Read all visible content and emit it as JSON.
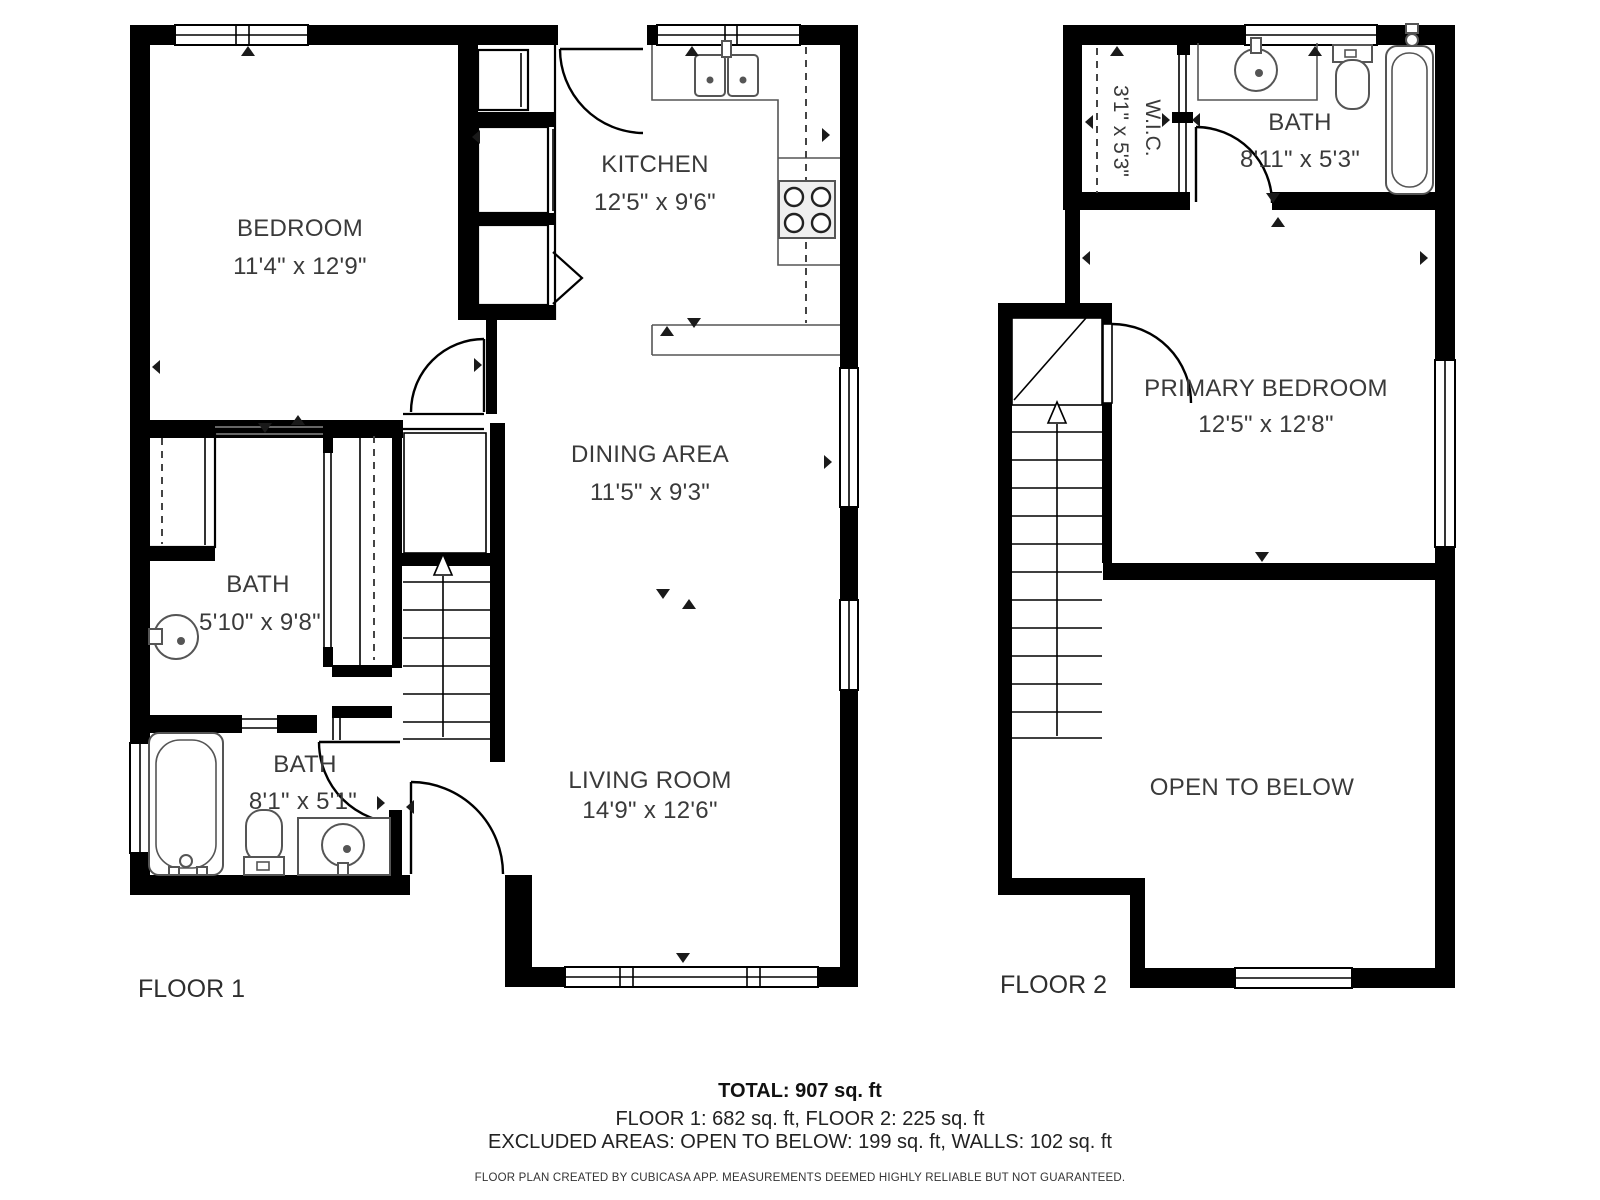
{
  "colors": {
    "wall": "#000000",
    "text": "#3a3a3a",
    "fixture": "#555555",
    "background": "#ffffff"
  },
  "floor1": {
    "label": "FLOOR 1",
    "bedroom": {
      "name": "BEDROOM",
      "dims": "11'4\" x 12'9\""
    },
    "kitchen": {
      "name": "KITCHEN",
      "dims": "12'5\" x 9'6\""
    },
    "dining": {
      "name": "DINING AREA",
      "dims": "11'5\" x 9'3\""
    },
    "bath_upper": {
      "name": "BATH",
      "dims": "5'10\" x 9'8\""
    },
    "bath_lower": {
      "name": "BATH",
      "dims": "8'1\" x 5'1\""
    },
    "living": {
      "name": "LIVING ROOM",
      "dims": "14'9\" x 12'6\""
    }
  },
  "floor2": {
    "label": "FLOOR 2",
    "wic": {
      "name": "W.I.C.",
      "dims": "3'1\" x 5'3\""
    },
    "bath": {
      "name": "BATH",
      "dims": "8'11\" x 5'3\""
    },
    "primary_bedroom": {
      "name": "PRIMARY BEDROOM",
      "dims": "12'5\" x 12'8\""
    },
    "open_to_below": {
      "name": "OPEN TO BELOW"
    }
  },
  "summary": {
    "total": "TOTAL: 907 sq. ft",
    "floors": "FLOOR 1: 682 sq. ft, FLOOR 2: 225 sq. ft",
    "excluded": "EXCLUDED AREAS: OPEN TO BELOW: 199 sq. ft, WALLS: 102 sq. ft",
    "disclaimer": "FLOOR PLAN CREATED BY CUBICASA APP. MEASUREMENTS DEEMED HIGHLY RELIABLE BUT NOT GUARANTEED."
  },
  "fixtures": [
    "kitchen-sink",
    "stove",
    "bathtub",
    "toilet",
    "vanity-sink",
    "pedestal-sink",
    "shower-tub",
    "stairs",
    "wardrobe-closet"
  ]
}
